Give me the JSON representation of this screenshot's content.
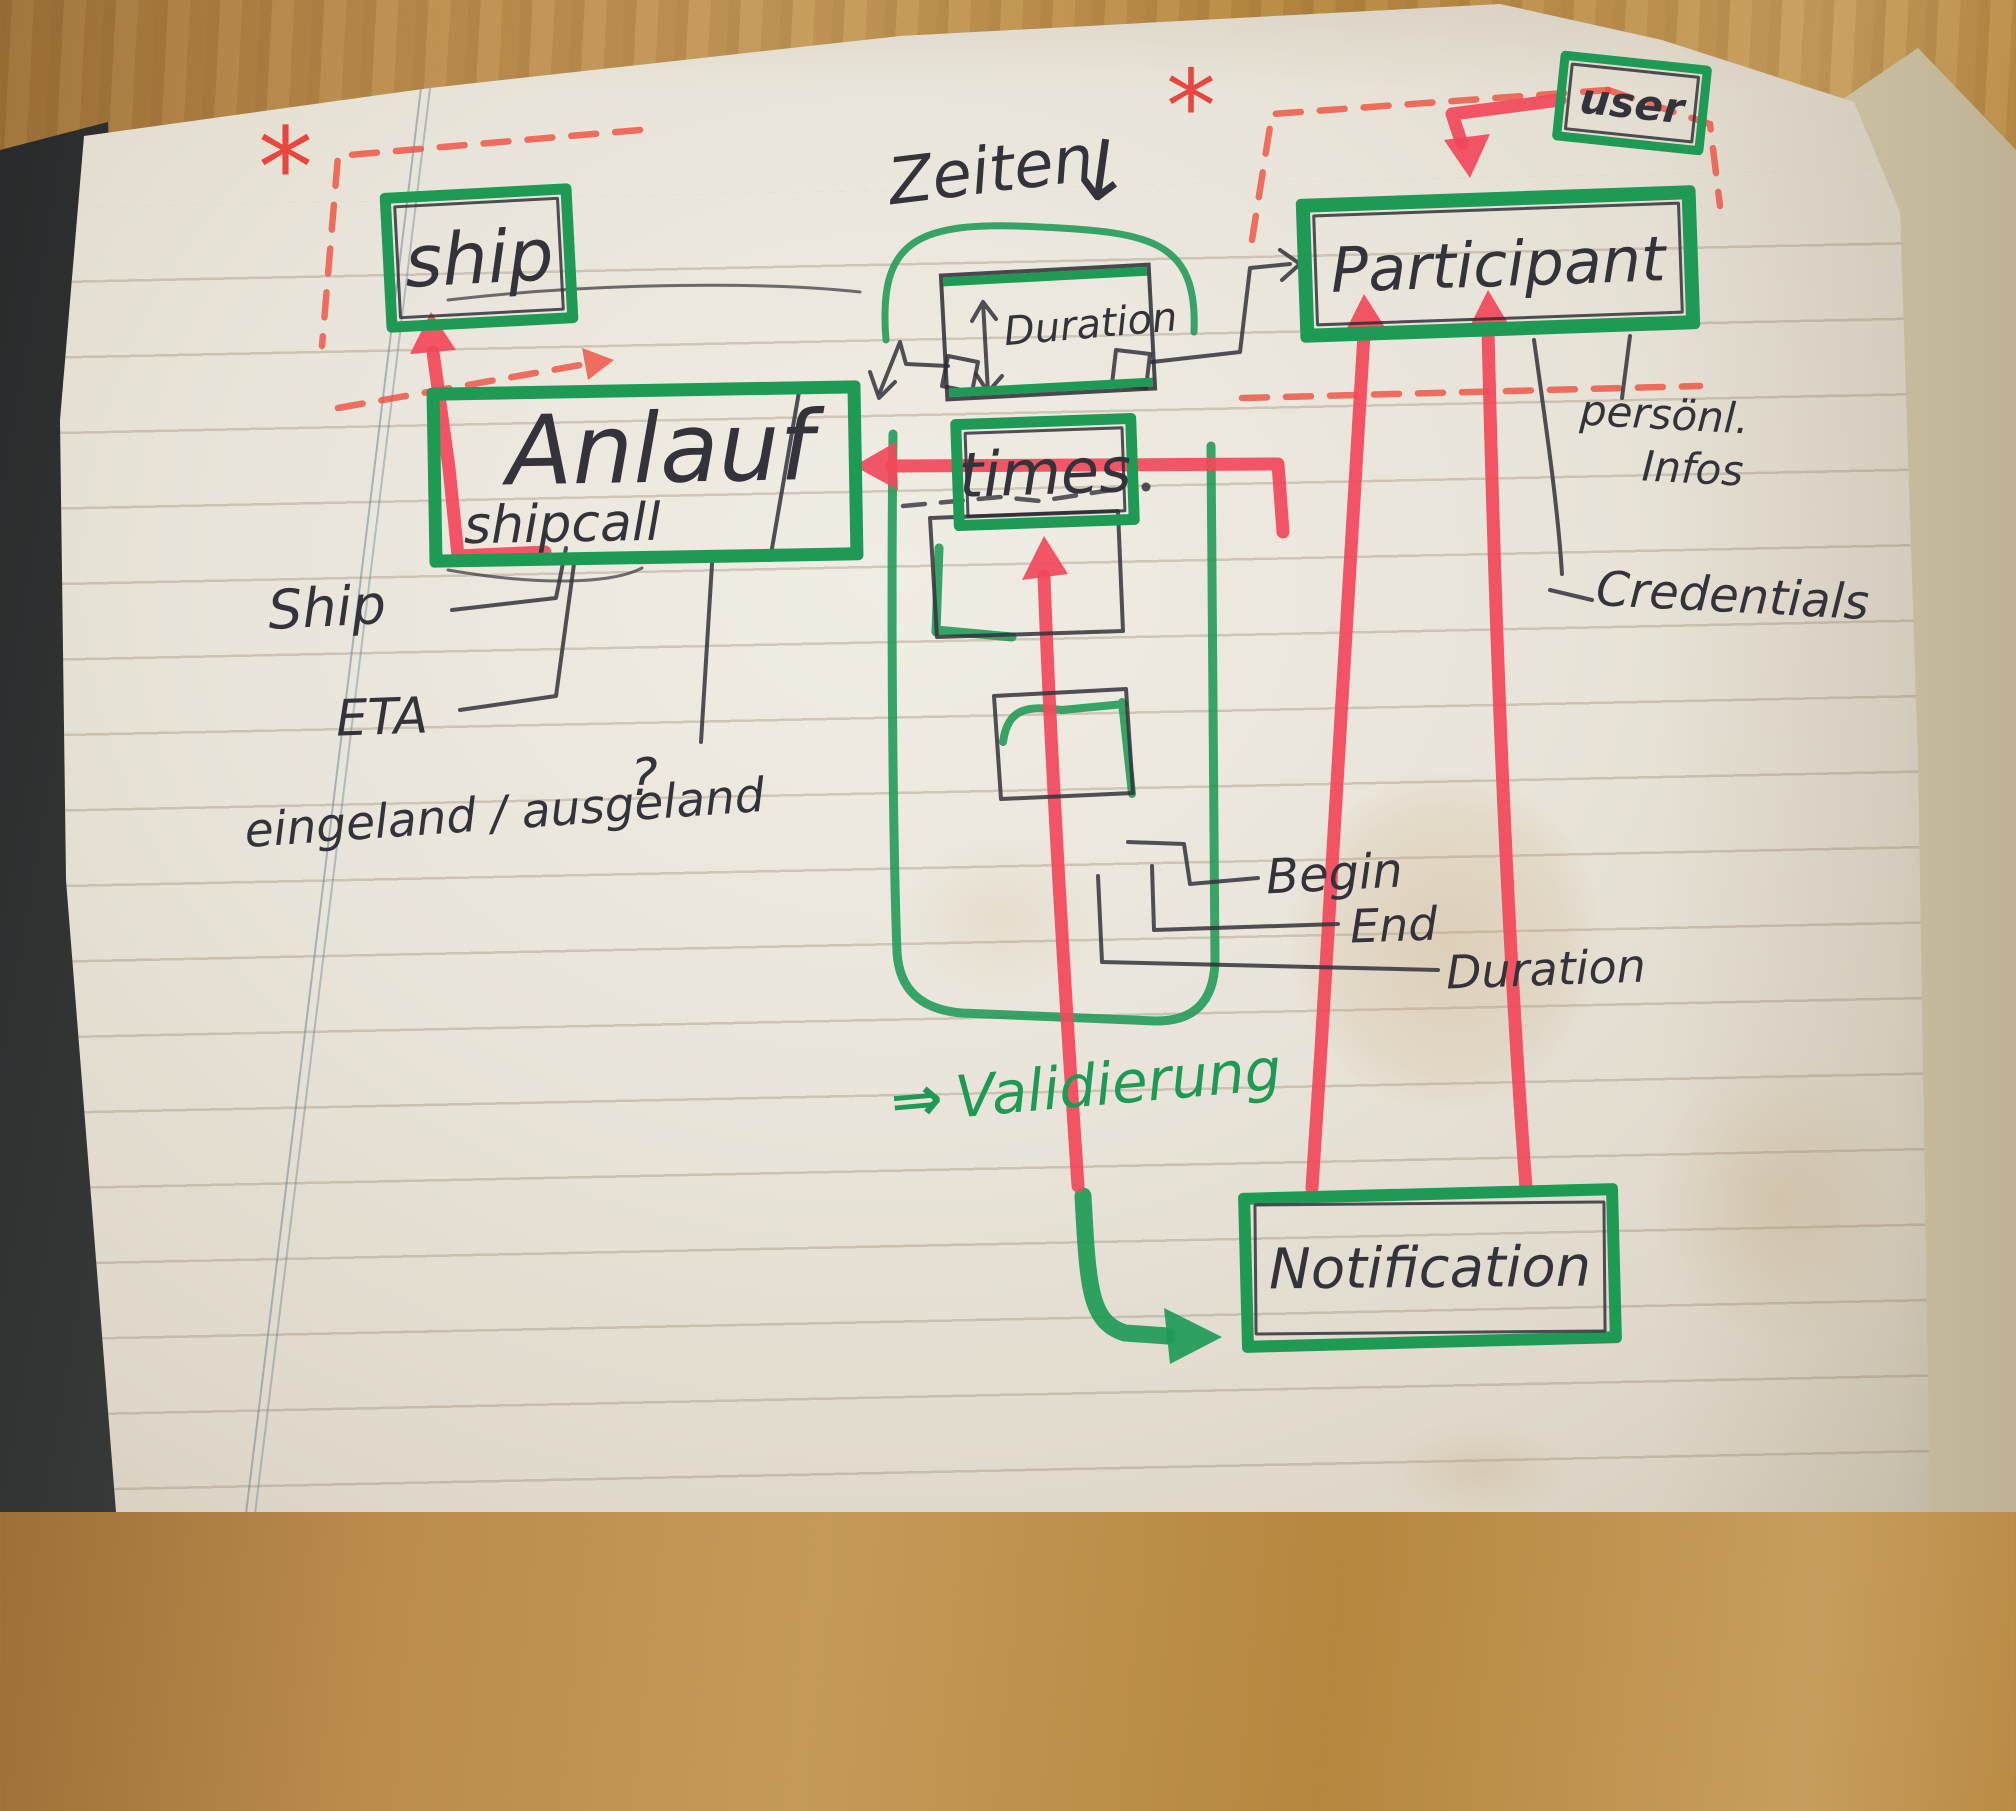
{
  "diagram": {
    "entities": {
      "ship": {
        "label": "ship"
      },
      "anlauf": {
        "label": "Anlauf",
        "sublabel": "shipcall"
      },
      "duration_box": {
        "label": "Duration"
      },
      "times": {
        "label": "times"
      },
      "participant": {
        "label": "Participant"
      },
      "user": {
        "label": "user"
      },
      "notification": {
        "label": "Notification"
      }
    },
    "attributes": {
      "ship_attr": "Ship",
      "eta": "ETA",
      "ein_aus": "eingeland / ausgeland",
      "question_mark": "?",
      "begin": "Begin",
      "end": "End",
      "duration_attr": "Duration",
      "persoenl_line1": "persönl.",
      "persoenl_line2": "Infos",
      "credentials": "Credentials"
    },
    "annotations": {
      "zeiten": "Zeiten",
      "zeiten_arrow": "↓",
      "validierung_arrow": "⇒",
      "validierung": "Validierung",
      "asterisk_left": "*",
      "asterisk_right": "*"
    },
    "colors": {
      "marker_green": "#1e9a55",
      "marker_red": "#f2485a",
      "dashed_red": "#ee4f3e",
      "pen": "#34333c",
      "paper": "#e9e4d9"
    }
  }
}
